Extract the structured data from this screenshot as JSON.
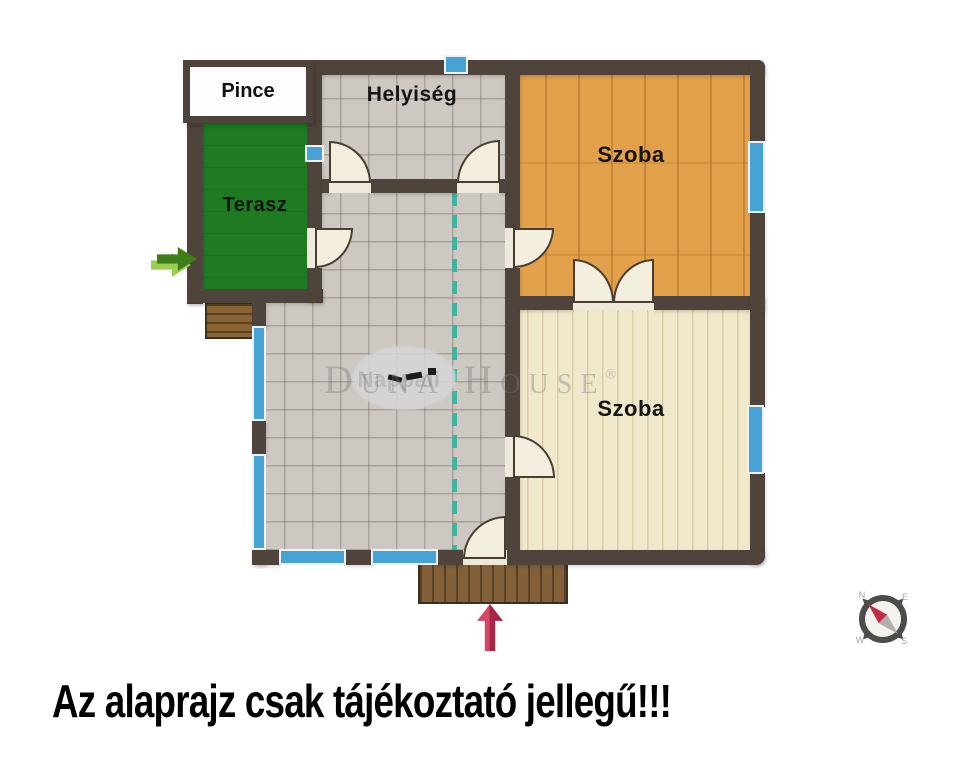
{
  "rooms": {
    "pince": "Pince",
    "terasz": "Terasz",
    "helyiseg": "Helyiség",
    "szoba_top": "Szoba",
    "nappali": "Nappali",
    "szoba_bottom": "Szoba"
  },
  "watermark": {
    "text": "Duna House",
    "registered": "®"
  },
  "compass": {
    "n": "N",
    "e": "E",
    "w": "W",
    "s": "S"
  },
  "disclaimer": "Az alaprajz csak tájékoztató jellegű!!!",
  "colors": {
    "wall": "#4f443b",
    "window": "#47a3d6",
    "terrace_green": "#1e7b22",
    "tile_floor": "#cdc8c2",
    "wood_floor_warm": "#e2a04b",
    "wood_floor_light": "#f0e8ca",
    "deck_brown": "#83603a",
    "divider_dashed_teal": "#3fb49e",
    "entry_arrow_red": "#c92e52",
    "side_arrow_green": "#3f7d19",
    "compass_needle_red": "#c22b45"
  }
}
